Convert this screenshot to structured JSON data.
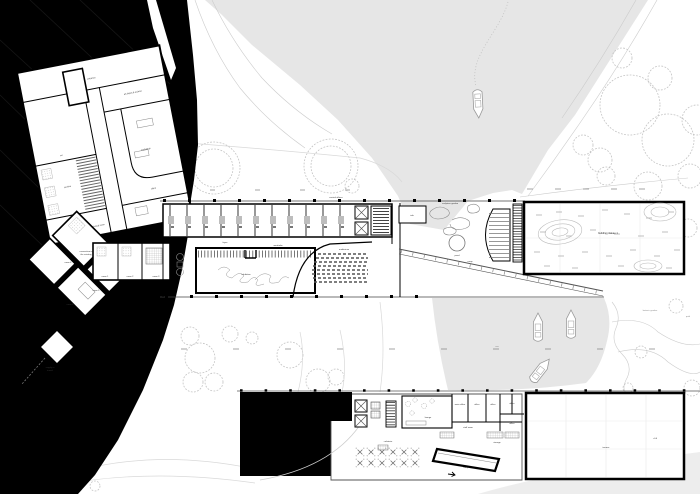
{
  "labels": {
    "upper": {
      "entrance": "entrance",
      "depot": "art depot & archive",
      "workshop": "workshop",
      "office": "office",
      "wc": "wc",
      "archive": "archive",
      "technical": "technical room"
    },
    "cluster": {
      "r1": "room 1",
      "r2": "room 2",
      "r3": "room 3",
      "r4": "room 4",
      "r5": "room 5",
      "r6": "room 6",
      "connection1": "connection to",
      "connection2": "the existing",
      "supply1": "supply in",
      "supply2": "tunnel"
    },
    "central": {
      "offices": "central offices",
      "exhibition": "exhibition",
      "wardrobe": "wardrobe",
      "auditorium": "auditorium",
      "foyer": "foyer"
    },
    "plaza": {
      "info": "info",
      "garden": "sculpture garden",
      "pond": "pond",
      "ramp": "ramp"
    },
    "right_building": {
      "plateau": "building plateau 1"
    },
    "water": {
      "sea": "sea",
      "garden": "botanic garden",
      "path": "path"
    },
    "bottom": {
      "lounge": "lounge",
      "main_office": "main office",
      "office1": "office",
      "office2": "office",
      "side_office1": "office",
      "side_office2": "office",
      "staff": "staff room",
      "storage": "storage",
      "cafeteria": "cafeteria",
      "ramp": "ramp",
      "terrace": "terrace",
      "level": "+0.0"
    }
  },
  "colors": {
    "water": "#e6e6e6",
    "hill": "#000000",
    "paper": "#ffffff"
  }
}
